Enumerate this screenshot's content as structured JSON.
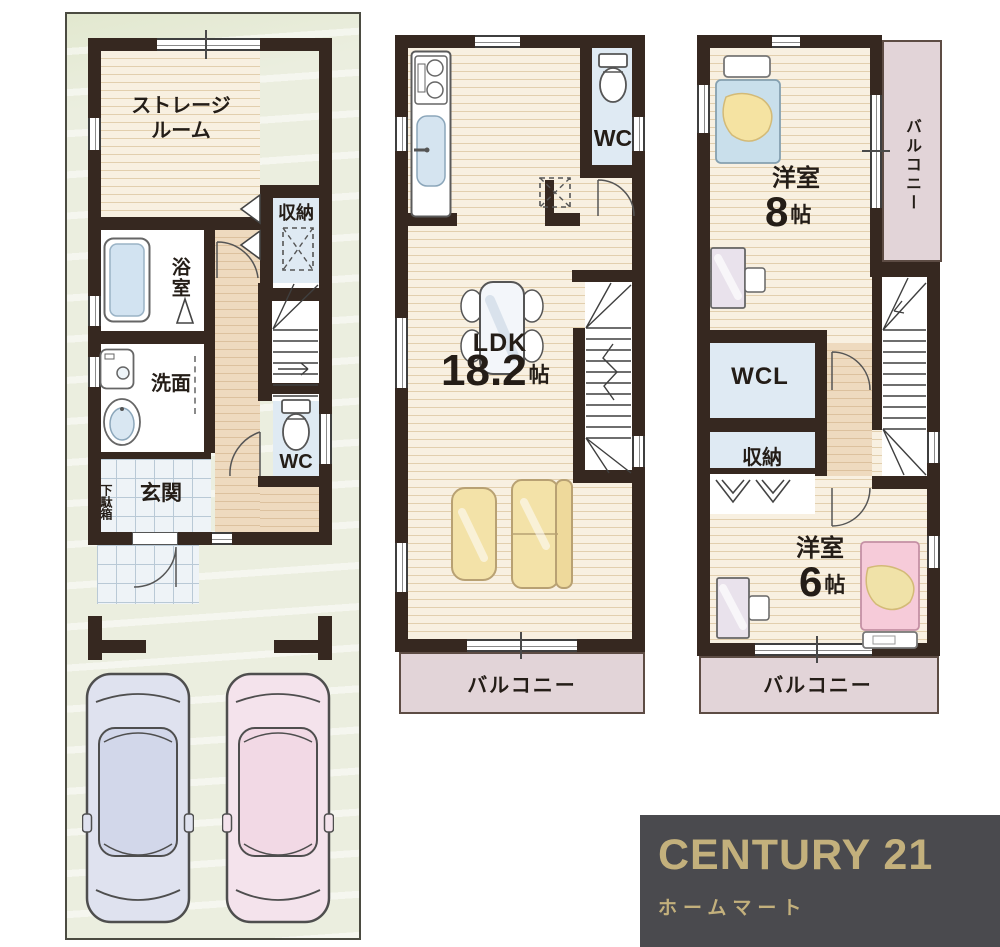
{
  "plan1": {
    "labels": {
      "storage_line1": "ストレージ",
      "storage_line2": "ルーム",
      "closet": "収納",
      "bath": "浴室",
      "washroom": "洗面",
      "entrance": "玄関",
      "shoe_cabinet": "下駄箱",
      "wc": "WC"
    }
  },
  "plan2": {
    "labels": {
      "wc": "WC",
      "ldk": "LDK",
      "ldk_size": "18.2",
      "ldk_unit": "帖",
      "balcony": "バルコニー"
    }
  },
  "plan3": {
    "labels": {
      "room8": "洋室",
      "room8_size": "8",
      "room8_unit": "帖",
      "balcony_side": "バルコニー",
      "wcl": "WCL",
      "closet": "収納",
      "room6": "洋室",
      "room6_size": "6",
      "room6_unit": "帖",
      "balcony_bottom": "バルコニー"
    }
  },
  "logo": {
    "brand": "CENTURY 21",
    "shop": "ホームマート",
    "bg_color": "#4a4a4e",
    "text_color": "#c3b07c"
  },
  "colors": {
    "wall": "#362820",
    "wood_floor": "#f8f0e1",
    "hall_floor": "#eedabf",
    "room_blue": "#dfeaf3",
    "balcony": "#e2d4d8",
    "lot_green": "#e8ecda",
    "sofa_yellow": "#f3e2a8",
    "car_blue": "#dfe2ef",
    "car_pink": "#f4e3ec"
  }
}
